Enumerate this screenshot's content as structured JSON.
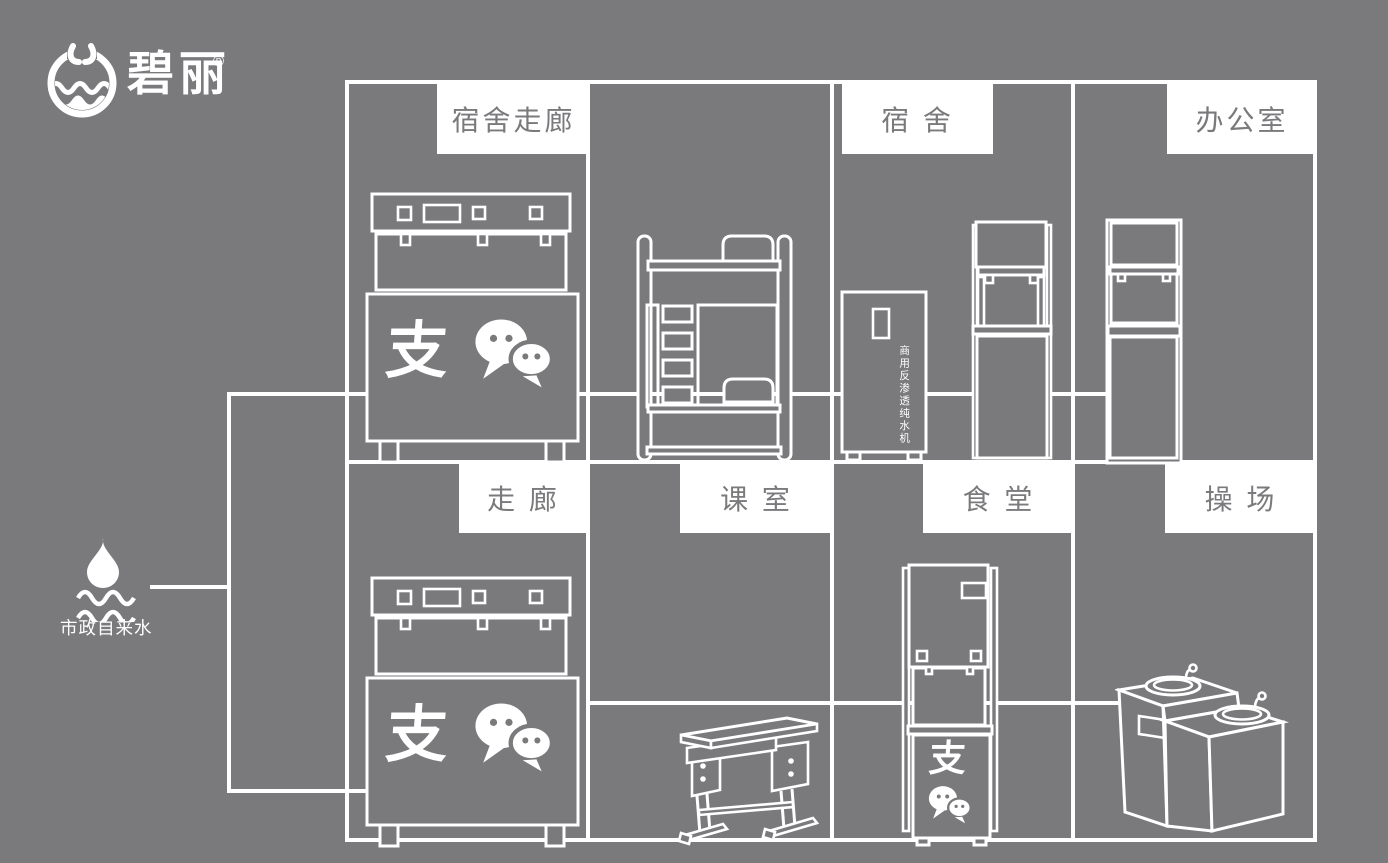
{
  "colors": {
    "background": "#7a7a7d",
    "line": "#ffffff",
    "label_bg": "#ffffff",
    "label_text": "#7a7a7d"
  },
  "logo": {
    "brand": "碧丽",
    "registered_mark": "®"
  },
  "water_source": {
    "label": "市政自来水"
  },
  "room_labels": {
    "dorm_corridor": "宿舍走廊",
    "dorm": "宿 舍",
    "office": "办公室",
    "corridor": "走 廊",
    "classroom": "课 室",
    "canteen": "食 堂",
    "playground": "操 场"
  },
  "equipment": {
    "purifier_label": "商用反渗透纯水机",
    "alipay_glyph": "支"
  },
  "icons": {
    "logo_emblem": "water-cup-wave-icon",
    "source": "water-drop-waves-icon",
    "payments": [
      "alipay-icon",
      "wechat-pay-icon"
    ]
  }
}
